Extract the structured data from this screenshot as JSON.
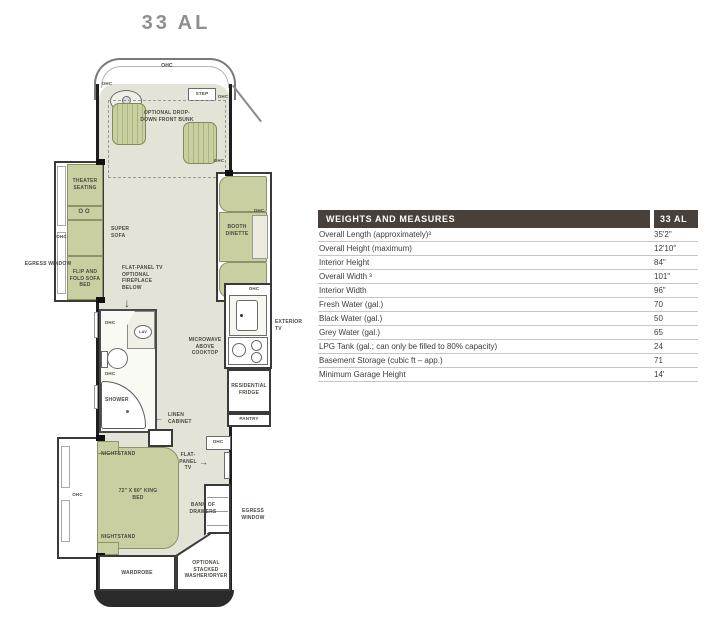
{
  "page": {
    "title": "33 AL"
  },
  "plan": {
    "labels": {
      "ohc": "OHC",
      "step": "STEP",
      "front_bunk": "OPTIONAL DROP-DOWN FRONT BUNK",
      "theater_seating": "THEATER SEATING",
      "cupholders": "OO",
      "super_sofa": "SUPER SOFA",
      "flip_fold_sofa": "FLIP AND FOLD SOFA BED",
      "egress_window": "EGRESS WINDOW",
      "booth_dinette": "BOOTH DINETTE",
      "tv_fireplace": "FLAT-PANEL TV OPTIONAL FIREPLACE BELOW",
      "down_arrow": "↓",
      "left_arrow": "←",
      "right_arrow": "→",
      "lav": "LAV",
      "shower": "SHOWER",
      "microwave": "MICROWAVE ABOVE COOKTOP",
      "exterior_tv": "EXTERIOR TV",
      "residential_fridge": "RESIDENTIAL FRIDGE",
      "pantry": "PANTRY",
      "linen_cabinet": "LINEN CABINET",
      "nightstand": "NIGHTSTAND",
      "king_bed": "72\" X 80\" KING BED",
      "flat_panel_tv": "FLAT-PANEL TV",
      "bank_of_drawers": "BANK OF DRAWERS",
      "wardrobe": "WARDROBE",
      "washer_dryer": "OPTIONAL STACKED WASHER/DRYER"
    },
    "colors": {
      "furniture": "#c9cfa0",
      "floor": "#e4e3d7",
      "wall": "#1f1f1f"
    }
  },
  "spec_table": {
    "header": {
      "title": "WEIGHTS AND MEASURES",
      "model": "33 AL",
      "bg": "#49403a"
    },
    "rows": [
      {
        "label": "Overall Length (approximately)³",
        "value": "35'2\""
      },
      {
        "label": "Overall Height (maximum)",
        "value": "12'10\""
      },
      {
        "label": "Interior Height",
        "value": "84\""
      },
      {
        "label": "Overall Width ³",
        "value": "101\""
      },
      {
        "label": "Interior Width",
        "value": "96\""
      },
      {
        "label": "Fresh Water (gal.)",
        "value": "70"
      },
      {
        "label": "Black Water (gal.)",
        "value": "50"
      },
      {
        "label": "Grey Water (gal.)",
        "value": "65"
      },
      {
        "label": "LPG Tank (gal.; can only be filled to 80% capacity)",
        "value": "24"
      },
      {
        "label": "Basement Storage (cubic ft – app.)",
        "value": "71"
      },
      {
        "label": "Minimum Garage Height",
        "value": "14'"
      }
    ]
  }
}
